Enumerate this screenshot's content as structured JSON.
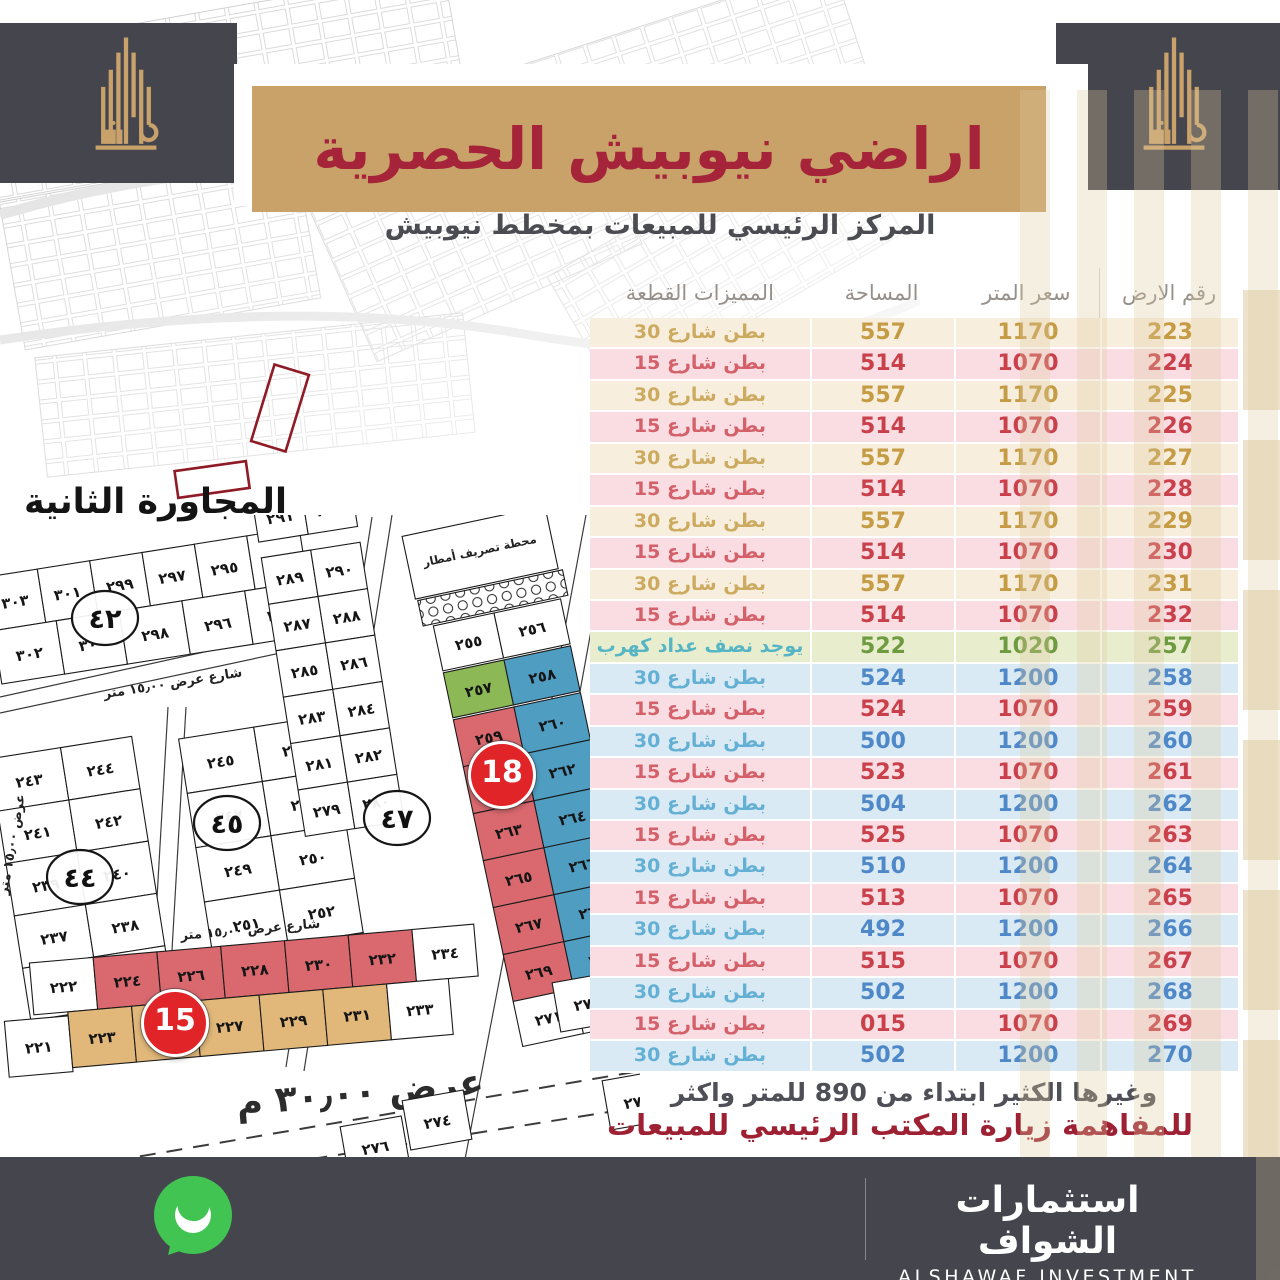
{
  "header": {
    "title": "اراضي نيوبيش الحصرية",
    "subtitle": "المركز الرئيسي للمبيعات بمخطط نيوبيش"
  },
  "table": {
    "headers": {
      "number": "رقم الارض",
      "price": "سعر المتر",
      "area": "المساحة",
      "features": "المميزات القطعة"
    },
    "rows": [
      {
        "number": "223",
        "price": "1170",
        "area": "557",
        "features": "بطن شارع 30",
        "variant": "gold"
      },
      {
        "number": "224",
        "price": "1070",
        "area": "514",
        "features": "بطن شارع 15",
        "variant": "red"
      },
      {
        "number": "225",
        "price": "1170",
        "area": "557",
        "features": "بطن شارع 30",
        "variant": "gold"
      },
      {
        "number": "226",
        "price": "1070",
        "area": "514",
        "features": "بطن شارع 15",
        "variant": "red"
      },
      {
        "number": "227",
        "price": "1170",
        "area": "557",
        "features": "بطن شارع 30",
        "variant": "gold"
      },
      {
        "number": "228",
        "price": "1070",
        "area": "514",
        "features": "بطن شارع 15",
        "variant": "red"
      },
      {
        "number": "229",
        "price": "1170",
        "area": "557",
        "features": "بطن شارع 30",
        "variant": "gold"
      },
      {
        "number": "230",
        "price": "1070",
        "area": "514",
        "features": "بطن شارع 15",
        "variant": "red"
      },
      {
        "number": "231",
        "price": "1170",
        "area": "557",
        "features": "بطن شارع 30",
        "variant": "gold"
      },
      {
        "number": "232",
        "price": "1070",
        "area": "514",
        "features": "بطن شارع 15",
        "variant": "red"
      },
      {
        "number": "257",
        "price": "1020",
        "area": "522",
        "features": "يوجد نصف عداد كهرب",
        "variant": "green"
      },
      {
        "number": "258",
        "price": "1200",
        "area": "524",
        "features": "بطن شارع 30",
        "variant": "blue"
      },
      {
        "number": "259",
        "price": "1070",
        "area": "524",
        "features": "بطن شارع 15",
        "variant": "red"
      },
      {
        "number": "260",
        "price": "1200",
        "area": "500",
        "features": "بطن شارع 30",
        "variant": "blue"
      },
      {
        "number": "261",
        "price": "1070",
        "area": "523",
        "features": "بطن شارع 15",
        "variant": "red"
      },
      {
        "number": "262",
        "price": "1200",
        "area": "504",
        "features": "بطن شارع 30",
        "variant": "blue"
      },
      {
        "number": "263",
        "price": "1070",
        "area": "525",
        "features": "بطن شارع 15",
        "variant": "red"
      },
      {
        "number": "264",
        "price": "1200",
        "area": "510",
        "features": "بطن شارع 30",
        "variant": "blue"
      },
      {
        "number": "265",
        "price": "1070",
        "area": "513",
        "features": "بطن شارع 15",
        "variant": "red"
      },
      {
        "number": "266",
        "price": "1200",
        "area": "492",
        "features": "بطن شارع 30",
        "variant": "blue"
      },
      {
        "number": "267",
        "price": "1070",
        "area": "515",
        "features": "بطن شارع 15",
        "variant": "red"
      },
      {
        "number": "268",
        "price": "1200",
        "area": "502",
        "features": "بطن شارع 30",
        "variant": "blue"
      },
      {
        "number": "269",
        "price": "1070",
        "area": "015",
        "features": "بطن شارع 15",
        "variant": "red"
      },
      {
        "number": "270",
        "price": "1200",
        "area": "502",
        "features": "بطن شارع 30",
        "variant": "blue"
      }
    ]
  },
  "notes": {
    "more": "وغيرها الكثير ابتداء من 890 للمتر واكثر",
    "visit": "للمفاهمة زيارة المكتب الرئيسي للمبيعات"
  },
  "contact": {
    "phone": "050 612 0999",
    "company_ar": "استثمارات الشواف",
    "company_en": "ALSHAWAF INVESTMENT"
  },
  "map": {
    "district_label": "المجاورة الثانية",
    "badge_15": "15",
    "badge_18": "18",
    "street_15": "شارع عرض ١٥٫٠٠ متر",
    "street_15_side": "عرض ١٥٫٠٠ متر",
    "street_30": "عرض ٣٠٫٠٠ م",
    "station": "محطة تصريف أمطار",
    "circles": [
      "٤٢",
      "٤٤",
      "٤٥",
      "٤٧"
    ],
    "block_a": [
      "٣٠٣",
      "٣٠١",
      "٢٩٩",
      "٢٩٧",
      "٢٩٥",
      "٢٩٣",
      "٣٠٢",
      "٣٠٠",
      "٢٩٨",
      "٢٩٦",
      "٢٩٤"
    ],
    "block_b": [
      "٢٤٣",
      "٢٤٤",
      "٢٤١",
      "٢٤٢",
      "٢٣٩",
      "٢٤٠",
      "٢٣٧",
      "٢٣٨",
      "٢٣٥",
      "٢٣٦"
    ],
    "block_c": [
      "٢٤٥",
      "٢٤٦",
      "٢٤٧",
      "٢٤٨",
      "٢٤٩",
      "٢٥٠",
      "٢٥١",
      "٢٥٢",
      "٢٥٣",
      "٢٥٤"
    ],
    "block_47": [
      "٢٨٩",
      "٢٩٠",
      "٢٨٧",
      "٢٨٨",
      "٢٨٥",
      "٢٨٦",
      "٢٨٣",
      "٢٨٤",
      "٢٨١",
      "٢٨٢",
      "٢٧٩",
      "٢٨٠"
    ],
    "block_47_top": [
      "٢٩١",
      "٢٩٢"
    ],
    "strip18": {
      "white_top": [
        "٢٥٥",
        "٢٥٦"
      ],
      "green": "٢٥٧",
      "first_blue": "٢٥٨",
      "red": [
        "٢٥٩",
        "٢٦١",
        "٢٦٣",
        "٢٦٥",
        "٢٦٧",
        "٢٦٩"
      ],
      "blue": [
        "٢٦٠",
        "٢٦٢",
        "٢٦٤",
        "٢٦٦",
        "٢٦٨",
        "٢٧٠"
      ],
      "white_bottom": [
        "٢٧١",
        "٢٧٢"
      ]
    },
    "strip15": {
      "red": [
        "٢٢٤",
        "٢٢٦",
        "٢٢٨",
        "٢٣٠",
        "٢٣٢"
      ],
      "tan": [
        "٢٢٣",
        "٢٢٥",
        "٢٢٧",
        "٢٢٩",
        "٢٣١"
      ],
      "white_left": [
        "٢٢٢",
        "٢٢١"
      ],
      "white_right": [
        "٢٣٤",
        "٢٣٣"
      ]
    },
    "south_plots": [
      "٢٧٣",
      "٢٧٥",
      "٢٧٤",
      "٢٧٦"
    ]
  },
  "colors": {
    "banner_tan": "#c9a26a",
    "title_red": "#a5243a",
    "dark_gray": "#45454d",
    "badge_red": "#e02427",
    "row_gold_bg": "#f8eedd",
    "row_gold_text": "#c59b44",
    "row_pink_bg": "#f9dde2",
    "row_red_text": "#c9404b",
    "row_green_bg": "#e7edcd",
    "row_green_text": "#6f9b40",
    "row_teal_text": "#56b5c5",
    "row_blue_bg": "#d9eaf4",
    "row_blue_text": "#4f88c8",
    "whatsapp_green": "#41c452"
  }
}
